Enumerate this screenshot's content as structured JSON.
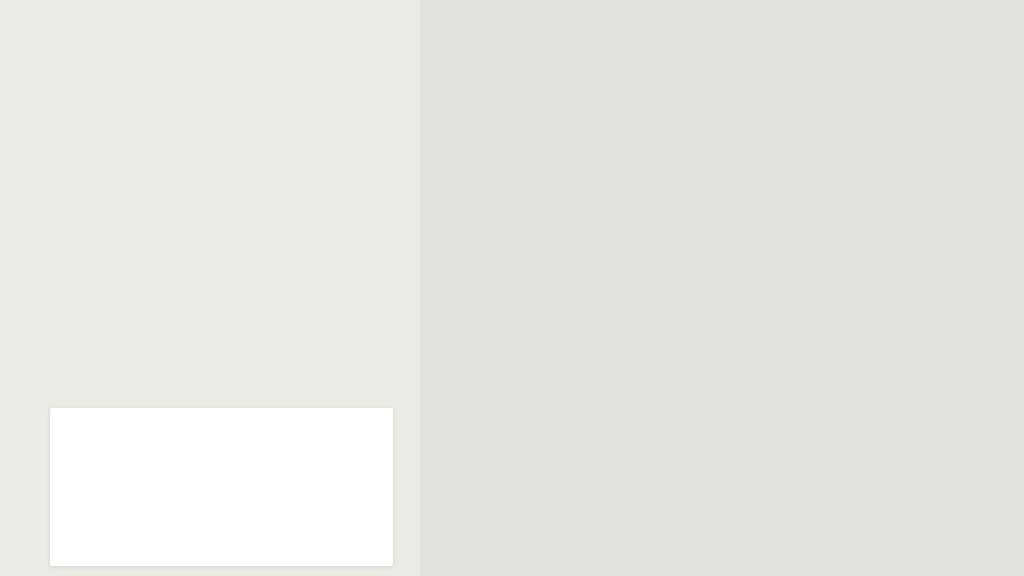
{
  "panel": {
    "description_segments": [
      {
        "text": "De las calles ",
        "bold": false
      },
      {
        "text": "Doctor Eduardo San Martín",
        "bold": true
      },
      {
        "text": " desde Avda. Defensores del Chaco hasta la Avda. La Victoria",
        "bold": false
      },
      {
        "text": "",
        "bold": false,
        "break": true
      },
      {
        "text": "Y Epifanio Mendez fleitas",
        "bold": true
      },
      {
        "text": " desde la Avda. La Victoria hasta Avda. Defensores del Chaco.",
        "bold": false
      }
    ],
    "apartir_label": "A partir del",
    "date": "19/12/18",
    "colors": {
      "maroon": "#8d2334",
      "date_green": "#1e7030",
      "title_green": "#107a37"
    },
    "legend": {
      "title": "REFERENCIAS",
      "items": [
        {
          "label": "Itinerario salida",
          "color": "#17a286"
        },
        {
          "label": "Itinerario entrada",
          "color": "#7d3abd"
        }
      ]
    },
    "ghost_labels": [
      {
        "t": "Curupay",
        "x": 36,
        "y": 44,
        "r": -48,
        "s": 11
      },
      {
        "t": "Eusebio Ayala",
        "x": 288,
        "y": 30,
        "r": 16,
        "s": 12,
        "c": "gave"
      },
      {
        "t": "Dr. Luís Frescura",
        "x": 278,
        "y": 294,
        "r": 6,
        "s": 9.5
      },
      {
        "t": "Concepción",
        "x": 0,
        "y": 390,
        "r": -62,
        "s": 10
      },
      {
        "t": "Mbocaya",
        "x": 0,
        "y": 408,
        "r": -22,
        "s": 10
      },
      {
        "t": "Ferreira",
        "x": 24,
        "y": 430,
        "r": -28,
        "s": 10
      },
      {
        "t": "Guarayos",
        "x": 262,
        "y": 342,
        "r": -55,
        "s": 10
      },
      {
        "t": "Tuples",
        "x": 316,
        "y": 356,
        "r": -55,
        "s": 10
      },
      {
        "t": "La Victoria",
        "x": 304,
        "y": 406,
        "r": -55,
        "s": 10
      },
      {
        "t": "14 de Abril",
        "x": 6,
        "y": 528,
        "r": -62,
        "s": 10
      }
    ]
  },
  "map": {
    "colors": {
      "bg": "#e3e1dc",
      "street": "#ffffff",
      "beige_district": "#eae1ca",
      "avenue_fill": "#f8e7a6",
      "avenue_edge": "#e9d084",
      "park": "#b4da8a",
      "block": "#f0e3c3",
      "route_salida": "#17a286",
      "route_entrada": "#7a30ba",
      "badge_entrada": "#5f2c9e",
      "badge_salida": "#17a286",
      "sign_ring": "#b53a33",
      "dash": "#b9b5ab",
      "bus": "#0d96a3"
    },
    "badges": [
      {
        "t": "DOCTOR EDUARDO SAN MARTÍN",
        "x": 612,
        "y": 152,
        "r": 15,
        "bg": "#5f2c9e",
        "name": "route-badge-entrada"
      },
      {
        "t": "EPIFANIO MENDEZ FLEITAS",
        "x": 622,
        "y": 249,
        "r": 15.5,
        "bg": "#17a286",
        "name": "route-badge-salida"
      }
    ],
    "routes": {
      "salida": {
        "color": "#17a286",
        "points": [
          [
            430,
            262
          ],
          [
            508,
            320
          ],
          [
            582,
            334
          ],
          [
            596,
            336
          ],
          [
            597,
            287
          ],
          [
            650,
            293
          ],
          [
            778,
            332
          ],
          [
            838,
            356
          ],
          [
            876,
            397
          ],
          [
            906,
            430
          ],
          [
            921,
            446
          ]
        ]
      },
      "entrada": {
        "color": "#7a30ba",
        "points": [
          [
            462,
            210
          ],
          [
            540,
            259
          ],
          [
            566,
            266
          ],
          [
            574,
            246
          ],
          [
            578,
            214
          ],
          [
            585,
            184
          ],
          [
            598,
            170
          ],
          [
            614,
            163
          ],
          [
            700,
            196
          ],
          [
            790,
            229
          ],
          [
            858,
            253
          ],
          [
            914,
            271
          ],
          [
            946,
            300
          ],
          [
            990,
            351
          ],
          [
            1014,
            383
          ]
        ]
      }
    },
    "oneway_signs": [
      {
        "x": 540,
        "y": 260,
        "r": 209
      },
      {
        "x": 670,
        "y": 207,
        "r": 197
      },
      {
        "x": 802,
        "y": 242,
        "r": 197
      },
      {
        "x": 921,
        "y": 274,
        "r": 193
      },
      {
        "x": 990,
        "y": 351,
        "r": 230
      },
      {
        "x": 510,
        "y": 318,
        "r": 25
      },
      {
        "x": 651,
        "y": 293,
        "r": 15
      },
      {
        "x": 778,
        "y": 332,
        "r": 15
      },
      {
        "x": 866,
        "y": 376,
        "r": 47
      },
      {
        "x": 921,
        "y": 440,
        "r": 55
      }
    ],
    "twoway_signs": [
      {
        "x": 616,
        "y": 212,
        "r": -15
      },
      {
        "x": 603,
        "y": 256,
        "r": -15
      }
    ],
    "bus_stop": {
      "x": 962,
      "y": 217
    },
    "mini_arrows": [
      {
        "x": 868,
        "y": 88,
        "r": 14
      },
      {
        "x": 838,
        "y": 128,
        "r": -55
      },
      {
        "x": 996,
        "y": 224,
        "r": 197
      }
    ],
    "avenue": {
      "x1": 330,
      "y1": 17,
      "x2": 1024,
      "y2": 245
    },
    "white_roads": [
      "M610,0 L552,92 L500,168 L452,230 L414,272",
      "M903,0 C894,60 899,118 924,166 C941,196 962,212 976,232 C990,250 1000,262 1010,276 L1024,295"
    ],
    "boundary_dash": "M872,186 L843,234 L806,294 L766,330 L655,428 L552,522",
    "beige_polygon": "1024,366 902,458 838,576 1024,576",
    "boundary_band": "M1024,368 L902,458 L838,570",
    "boundary_white": "M1024,366 L900,458 L836,576",
    "parks": [
      "686,0 775,0 778,45 690,24",
      "422,164 446,170 442,192 420,186",
      "888,372 927,385 913,414 874,400"
    ],
    "blocks": [
      "646,80 722,102 716,122 640,100",
      "712,52 770,68 762,112 706,94"
    ],
    "gray_streets": [
      [
        560,
        95,
        905,
        200,
        4
      ],
      [
        586,
        224,
        862,
        306,
        4
      ],
      [
        690,
        362,
        906,
        427,
        4
      ],
      [
        628,
        437,
        840,
        500,
        4
      ],
      [
        560,
        520,
        755,
        576,
        4
      ],
      [
        626,
        26,
        900,
        110,
        5
      ],
      [
        908,
        106,
        1024,
        142,
        4
      ],
      [
        650,
        112,
        528,
        508,
        5
      ],
      [
        712,
        152,
        620,
        462,
        4
      ],
      [
        800,
        142,
        698,
        468,
        4
      ],
      [
        870,
        190,
        788,
        438,
        4
      ],
      [
        508,
        196,
        428,
        338,
        4
      ],
      [
        598,
        160,
        470,
        398,
        4
      ],
      [
        586,
        242,
        514,
        450,
        4
      ],
      [
        636,
        290,
        553,
        546,
        4
      ],
      [
        680,
        330,
        614,
        548,
        3
      ],
      [
        706,
        330,
        648,
        560,
        3
      ],
      [
        748,
        385,
        842,
        562,
        4
      ],
      [
        845,
        478,
        1022,
        352,
        4
      ],
      [
        500,
        402,
        488,
        545,
        4
      ],
      [
        455,
        398,
        444,
        525,
        3
      ],
      [
        422,
        442,
        502,
        420,
        3
      ],
      [
        420,
        478,
        508,
        452,
        3
      ],
      [
        570,
        470,
        700,
        512,
        3
      ],
      [
        622,
        532,
        762,
        572,
        3
      ],
      [
        700,
        432,
        782,
        458,
        3
      ],
      [
        470,
        0,
        442,
        70,
        4
      ],
      [
        782,
        0,
        756,
        55,
        4
      ],
      [
        852,
        0,
        810,
        96,
        4
      ],
      [
        942,
        0,
        902,
        88,
        4
      ],
      [
        982,
        0,
        940,
        95,
        4
      ],
      [
        1022,
        28,
        976,
        135,
        4
      ],
      [
        908,
        42,
        1015,
        75,
        3
      ],
      [
        790,
        480,
        860,
        576,
        3
      ]
    ],
    "beige_streets": [
      [
        900,
        460,
        966,
        576,
        3
      ],
      [
        930,
        452,
        1012,
        576,
        3
      ],
      [
        962,
        431,
        1024,
        524,
        3
      ],
      [
        988,
        412,
        1024,
        464,
        3
      ],
      [
        864,
        490,
        922,
        576,
        3
      ],
      [
        868,
        546,
        1024,
        432,
        3
      ],
      [
        908,
        576,
        1024,
        492,
        3
      ]
    ],
    "panel_ghost_streets": [
      [
        60,
        0,
        0,
        92
      ],
      [
        140,
        0,
        28,
        208
      ],
      [
        305,
        52,
        210,
        150
      ],
      [
        350,
        95,
        250,
        210
      ],
      [
        40,
        250,
        140,
        340
      ],
      [
        0,
        300,
        90,
        390
      ],
      [
        60,
        540,
        200,
        480
      ],
      [
        260,
        310,
        380,
        365
      ],
      [
        300,
        430,
        410,
        405
      ],
      [
        335,
        475,
        420,
        445
      ],
      [
        150,
        400,
        260,
        360
      ],
      [
        90,
        430,
        30,
        520
      ]
    ],
    "street_labels": [
      {
        "t": "Avenida Eusebio Ayala",
        "x": 434,
        "y": 54,
        "r": 18,
        "s": 12.5,
        "c": "ave"
      },
      {
        "t": "Avenida Eusebio Ayala",
        "x": 700,
        "y": 141,
        "r": 18,
        "s": 12.5,
        "c": "ave"
      },
      {
        "t": "Avenida Eusebio Ayala",
        "x": 998,
        "y": 228,
        "r": 18,
        "s": 12.5,
        "c": "ave"
      },
      {
        "t": "R.I. 12 de",
        "x": 462,
        "y": 50,
        "r": -72,
        "s": 11
      },
      {
        "t": "R.I. 18 Pitiantuta",
        "x": 567,
        "y": 86,
        "r": -56,
        "s": 11.5
      },
      {
        "t": "Teresa Lamas Carísimo",
        "x": 642,
        "y": 18,
        "r": 17,
        "s": 11.5
      },
      {
        "t": "Mayor",
        "x": 776,
        "y": 30,
        "r": -65,
        "s": 11
      },
      {
        "t": "Prof Sergio Co",
        "x": 843,
        "y": 76,
        "r": -73,
        "s": 11
      },
      {
        "t": "Ángel E. L",
        "x": 932,
        "y": 42,
        "r": -72,
        "s": 11
      },
      {
        "t": "Mayor José Lama",
        "x": 965,
        "y": 97,
        "r": -72,
        "s": 11
      },
      {
        "t": "Capitán Pedro Villama",
        "x": 1002,
        "y": 138,
        "r": -72,
        "s": 11
      },
      {
        "t": "Músicos del Chaco",
        "x": 896,
        "y": 110,
        "r": 16,
        "s": 12
      },
      {
        "t": "Av. La Victoria",
        "x": 496,
        "y": 172,
        "r": -58,
        "s": 12
      },
      {
        "t": "INCAS",
        "x": 412,
        "y": 240,
        "r": -35,
        "s": 11
      },
      {
        "t": "Quebracho",
        "x": 448,
        "y": 314,
        "r": -60,
        "s": 12
      },
      {
        "t": "Veteranos De la Guerra Del Chaco",
        "x": 506,
        "y": 322,
        "r": -61,
        "s": 10.5
      },
      {
        "t": "Oscar Botta",
        "x": 546,
        "y": 350,
        "r": -62,
        "s": 11.5
      },
      {
        "t": "Tte. Jose Felix Lopez",
        "x": 588,
        "y": 282,
        "r": -77,
        "s": 10.5
      },
      {
        "t": "Corochire",
        "x": 626,
        "y": 242,
        "r": 14,
        "s": 11.5
      },
      {
        "t": "Von Sastrow",
        "x": 680,
        "y": 260,
        "r": -78,
        "s": 11
      },
      {
        "t": "Cacique",
        "x": 770,
        "y": 260,
        "r": -80,
        "s": 11
      },
      {
        "t": "Urruti",
        "x": 840,
        "y": 308,
        "r": -72,
        "s": 11
      },
      {
        "t": "ASUNCIÓN",
        "x": 816,
        "y": 284,
        "r": -56,
        "s": 10.5,
        "c": "bnd"
      },
      {
        "t": "DEPARTAMENTO CENTRAL",
        "x": 780,
        "y": 360,
        "r": -56,
        "s": 10.5,
        "c": "bnd"
      },
      {
        "t": "Tte. Jose Felix Lopez",
        "x": 538,
        "y": 484,
        "r": -73,
        "s": 10.5
      },
      {
        "t": "Veteranos de la Guerra del 70",
        "x": 556,
        "y": 492,
        "r": -73,
        "s": 10.5
      },
      {
        "t": "Jow. Von Sastrow",
        "x": 642,
        "y": 400,
        "r": -77,
        "s": 10.5
      },
      {
        "t": "Cacique",
        "x": 696,
        "y": 368,
        "r": -78,
        "s": 10.5
      },
      {
        "t": "Laurel",
        "x": 794,
        "y": 402,
        "r": 20,
        "s": 11.5
      },
      {
        "t": "Padre Albert Miguel Rigual",
        "x": 752,
        "y": 396,
        "r": 57,
        "s": 10.5
      },
      {
        "t": "Epifani",
        "x": 798,
        "y": 338,
        "r": 16,
        "s": 10.5
      },
      {
        "t": "Fleitas",
        "x": 850,
        "y": 412,
        "r": -74,
        "s": 10.5
      },
      {
        "t": "Tte. 1ro. Adalberto Ramírez Franco",
        "x": 858,
        "y": 436,
        "r": -49,
        "s": 10.5
      },
      {
        "t": "Dr. Hipólito Sánchez Qu",
        "x": 843,
        "y": 480,
        "r": -38,
        "s": 11
      },
      {
        "t": "Av Defensores del Chaco",
        "x": 858,
        "y": 498,
        "r": -37,
        "s": 12.5,
        "c": "maj"
      },
      {
        "t": "A Sosa",
        "x": 936,
        "y": 454,
        "r": 38,
        "s": 11
      },
      {
        "t": "Molina",
        "x": 941,
        "y": 480,
        "r": 52,
        "s": 11
      },
      {
        "t": "Florida",
        "x": 900,
        "y": 537,
        "r": 48,
        "s": 11
      },
      {
        "t": "Cástulo Franco",
        "x": 948,
        "y": 577,
        "r": -52,
        "s": 11
      },
      {
        "t": "Marcos Riera",
        "x": 970,
        "y": 422,
        "r": 35,
        "s": 11
      },
      {
        "t": "Fulgencio",
        "x": 990,
        "y": 402,
        "r": 33,
        "s": 11
      },
      {
        "t": "Mburucuya",
        "x": 414,
        "y": 442,
        "r": -66,
        "s": 11
      },
      {
        "t": "Ysapy",
        "x": 449,
        "y": 429,
        "r": 13,
        "s": 12
      },
      {
        "t": "Guavira",
        "x": 452,
        "y": 470,
        "r": 8,
        "s": 12
      },
      {
        "t": "Guaviyú",
        "x": 450,
        "y": 377,
        "r": -66,
        "s": 11
      }
    ]
  }
}
